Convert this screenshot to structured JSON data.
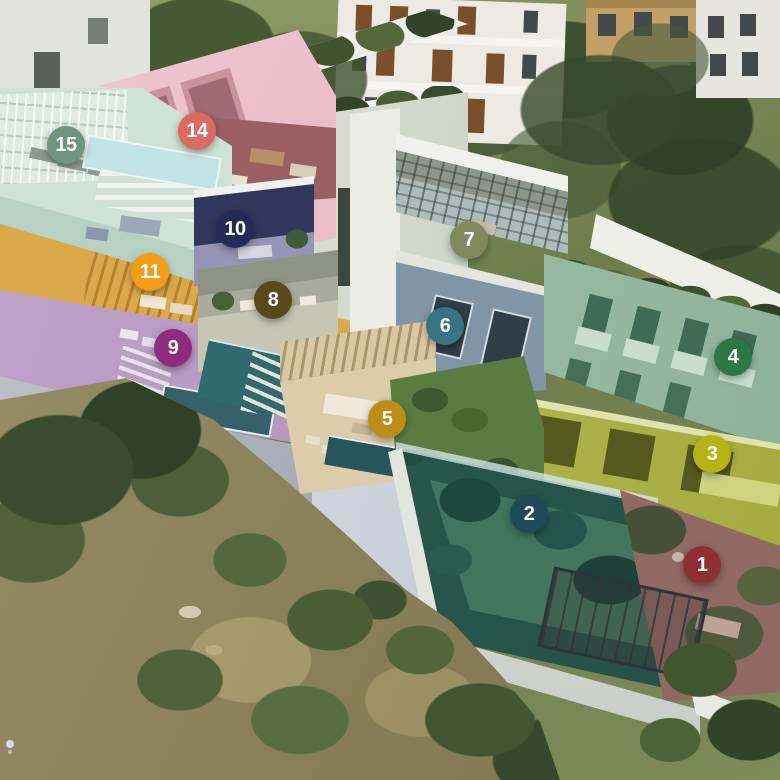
{
  "units": [
    {
      "number": "1",
      "color": "#8e3033",
      "x": 702,
      "y": 565
    },
    {
      "number": "2",
      "color": "#1e4956",
      "x": 529,
      "y": 514
    },
    {
      "number": "3",
      "color": "#b5b416",
      "x": 712,
      "y": 454
    },
    {
      "number": "4",
      "color": "#2c7747",
      "x": 733,
      "y": 357
    },
    {
      "number": "5",
      "color": "#bd8d15",
      "x": 387,
      "y": 419
    },
    {
      "number": "6",
      "color": "#377383",
      "x": 445,
      "y": 326
    },
    {
      "number": "7",
      "color": "#82885e",
      "x": 469,
      "y": 240
    },
    {
      "number": "8",
      "color": "#57491c",
      "x": 273,
      "y": 300
    },
    {
      "number": "9",
      "color": "#8d2c7c",
      "x": 173,
      "y": 348
    },
    {
      "number": "10",
      "color": "#252b59",
      "x": 235,
      "y": 229
    },
    {
      "number": "11",
      "color": "#f59d17",
      "x": 150,
      "y": 272
    },
    {
      "number": "14",
      "color": "#db6a62",
      "x": 197,
      "y": 131
    },
    {
      "number": "15",
      "color": "#6f9480",
      "x": 66,
      "y": 145
    }
  ]
}
